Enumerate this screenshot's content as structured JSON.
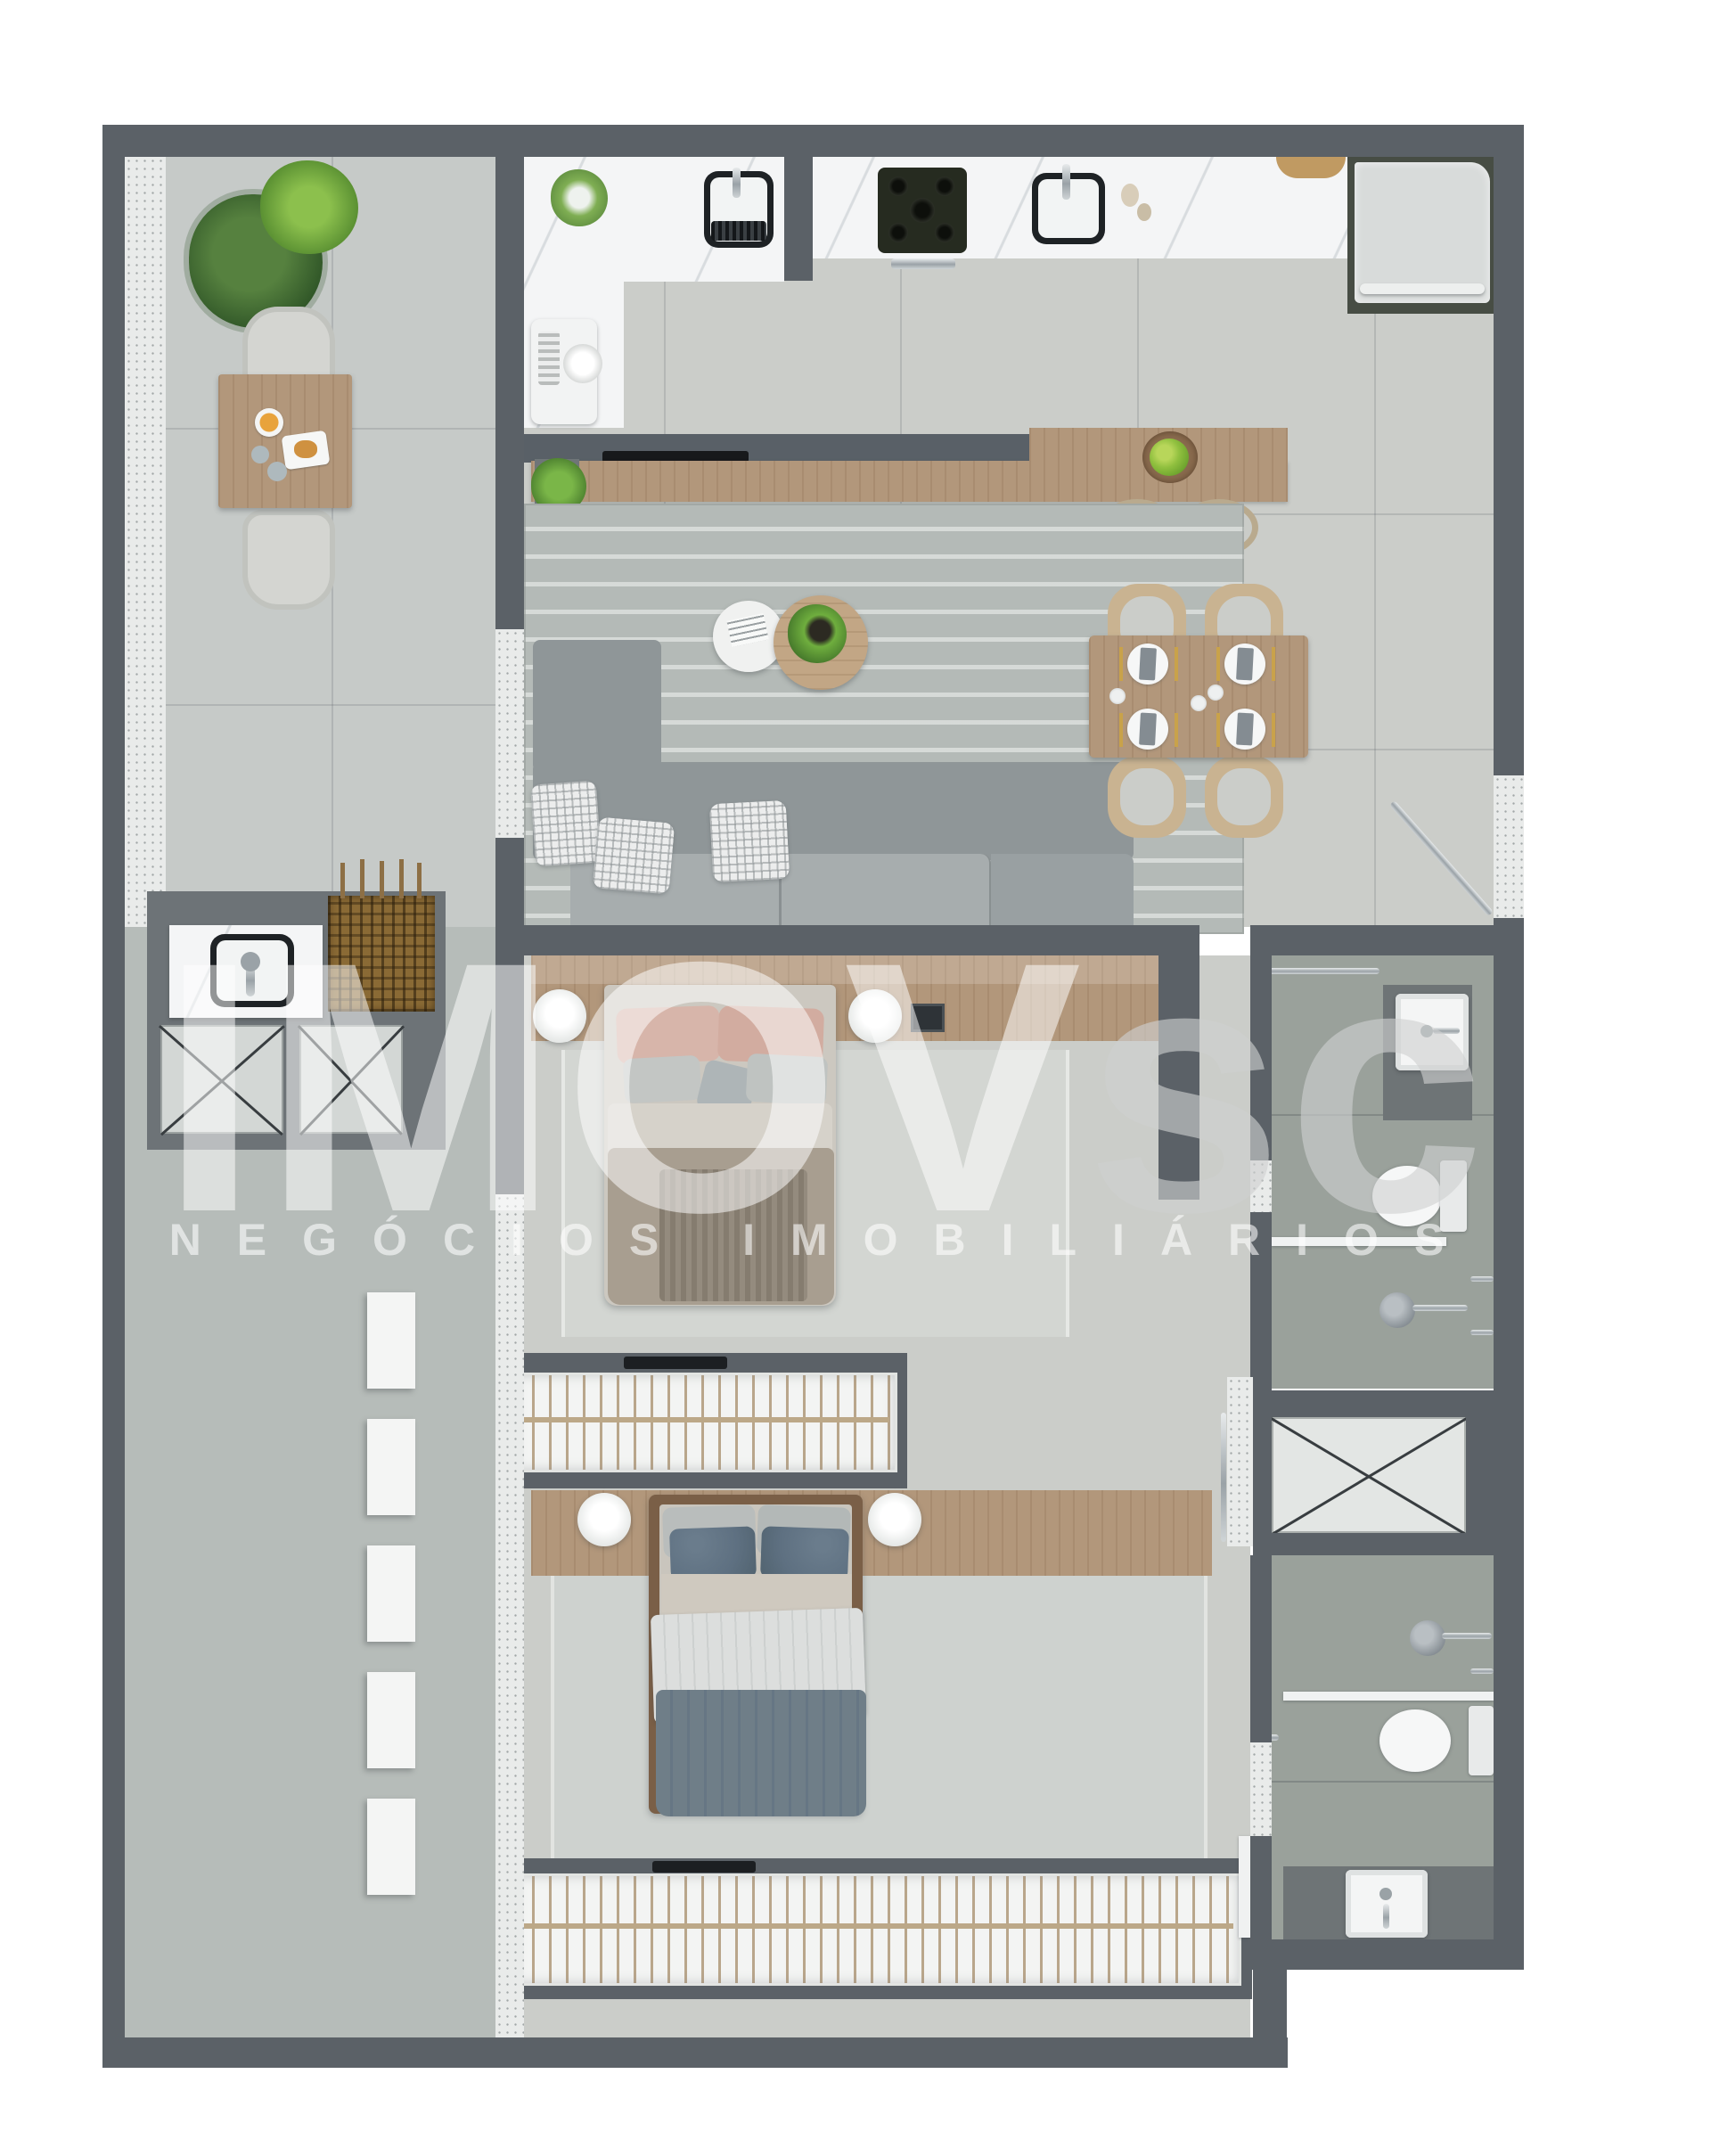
{
  "watermark": {
    "brand_main": "IMOV",
    "brand_suffix": "sc",
    "subtitle": "NEGÓCIOS IMOBILIÁRIOS"
  },
  "palette": {
    "background": "#ffffff",
    "wall": "#5b6167",
    "balcony_floor": "#c6cac8",
    "corridor_floor": "#b6bcb9",
    "interior_floor": "#cbcdc9",
    "bathroom_floor": "#9aa19b",
    "marble_counter": "#f4f5f6",
    "wood": "#b2977b",
    "wood_dark": "#7a5f47",
    "living_rug": "#b4bab7",
    "bedroom_rug": "#d2d5d1",
    "sofa_gray": "#959c9e",
    "appliance_gray": "#d8dbda",
    "bbq_brown": "#8a6a35",
    "pillow_pink": "#d7b5aa",
    "pillow_blue": "#5e7081",
    "duvet_taupe": "#a89e90",
    "duvet_blue_gray": "#6f7e88",
    "plant_green": "#4e7d3a",
    "chrome": "#aab0b4",
    "watermark_white": "rgba(255,255,255,0.55)",
    "watermark_gray": "rgba(206,209,209,0.62)"
  },
  "plan": {
    "type": "apartment-floor-plan-top-view",
    "rooms": [
      {
        "name": "balcony",
        "items": [
          "wicker-chair",
          "wicker-chair",
          "outdoor-table",
          "breakfast-tray",
          "fern-plant",
          "leaf-plant"
        ]
      },
      {
        "name": "kitchen",
        "items": [
          "counter-sink",
          "cooktop-5-burners",
          "second-sink",
          "refrigerator",
          "coffee-machine",
          "counter-plant",
          "cutting-board"
        ]
      },
      {
        "name": "living-room",
        "items": [
          "l-shaped-sofa",
          "checkered-pillows",
          "round-coffee-table-white",
          "round-coffee-table-wood",
          "table-plant",
          "striped-rug",
          "tv-console",
          "wood-sideboard",
          "fruit-bowl",
          "bar-stool",
          "bar-stool"
        ]
      },
      {
        "name": "dining-area",
        "items": [
          "dining-table",
          "chair",
          "chair",
          "chair",
          "chair",
          "place-setting",
          "place-setting",
          "place-setting",
          "place-setting"
        ]
      },
      {
        "name": "laundry-area",
        "items": [
          "laundry-sink",
          "barbecue-grill",
          "appliance-space-x",
          "appliance-space-x"
        ]
      },
      {
        "name": "hallway",
        "items": [
          "wall-shelf",
          "wall-shelf",
          "wall-shelf",
          "wall-shelf",
          "wall-shelf"
        ]
      },
      {
        "name": "bedroom-1",
        "items": [
          "double-bed",
          "pink-pillows",
          "headboard-shelf",
          "round-lamp",
          "round-lamp",
          "photo-frame",
          "rug",
          "wardrobe-with-hangers",
          "tv"
        ]
      },
      {
        "name": "bedroom-2",
        "items": [
          "double-bed",
          "blue-pillows",
          "headboard-shelf",
          "round-lamp",
          "round-lamp",
          "rug",
          "wardrobe-with-hangers",
          "tv"
        ]
      },
      {
        "name": "bathroom-1",
        "items": [
          "vanity-sink",
          "toilet",
          "hand-shower",
          "glass-partition",
          "towel-bar"
        ]
      },
      {
        "name": "bathroom-2",
        "items": [
          "vanity-sink",
          "toilet",
          "hand-shower",
          "glass-partition",
          "towel-bar",
          "door-leaf"
        ]
      },
      {
        "name": "service-shaft",
        "items": [
          "x-marked-shaft"
        ]
      },
      {
        "name": "entry",
        "items": [
          "entrance-door-leaf",
          "door-threshold"
        ]
      }
    ]
  }
}
